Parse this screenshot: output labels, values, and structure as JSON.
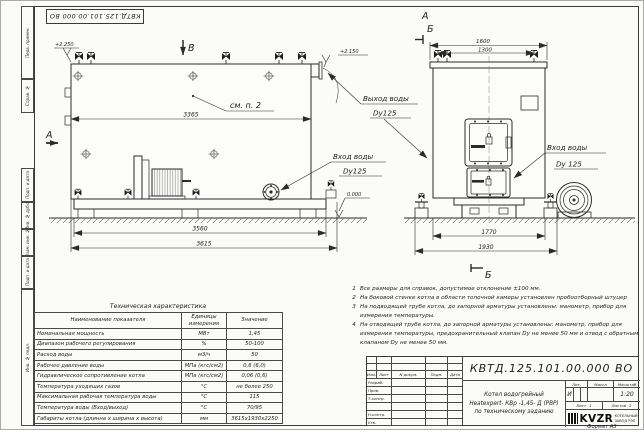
{
  "colors": {
    "line": "#2b2b2b",
    "paper": "#fbfbf8"
  },
  "sheet": {
    "stamp": "КВТД.125.101.00.000 ВО",
    "format": "Формат А3",
    "margin": [
      "Перв. примен.",
      "Справ. №",
      "Подп. и дата",
      "Инв. № дубл.",
      "Взам. инв. №",
      "Подп. и дата",
      "Инв. № подл."
    ]
  },
  "side": {
    "view_b": "В",
    "section_a": "А",
    "elev1": "+2.250",
    "elev2": "+2.150",
    "elev0": "0.000",
    "see_note": "см. п. 2",
    "dim_top": "3365",
    "dim_mid": "3560",
    "dim_out": "3615",
    "inlet1": "Вход воды",
    "inlet2": "Dy125",
    "outlet1": "Выход воды",
    "outlet2": "Dy125"
  },
  "front": {
    "label_a": "А",
    "label_b": "Б",
    "label_b2": "Б",
    "dim1": "1600",
    "dim2": "1300",
    "dim3": "1770",
    "dim4": "1930",
    "inlet1": "Вход воды",
    "inlet2": "Dy 125"
  },
  "notes": [
    {
      "n": "1",
      "t": "Все размеры для справок, допустимое отклонение ±100 мм."
    },
    {
      "n": "2",
      "t": "На боковой стенке котла в области топочной камеры установлен пробоотборный штуцер"
    },
    {
      "n": "3",
      "t": "На подводящей трубе котла, до запорной арматуры установлены: манометр, прибор для измерения температуры."
    },
    {
      "n": "4",
      "t": "На отводящей трубе котла, до запорной арматуры установлены: манометр, прибор для измерения температуры, предохранительный клапан Dу не менее 50 мм и отвод с обратным клапаном Dу не менее 50 мм."
    }
  ],
  "spec": {
    "title": "Техническая характеристика",
    "headers": [
      "Наименование показателя",
      "Единицы измерения",
      "Значение"
    ],
    "rows": [
      [
        "Номинальная мощность",
        "МВт",
        "1,45"
      ],
      [
        "Диапазон рабочего регулирования",
        "%",
        "50-100"
      ],
      [
        "Расход воды",
        "м3/ч",
        "50"
      ],
      [
        "Рабочее давление воды",
        "МПа (кгс/см2)",
        "0,6 (6,0)"
      ],
      [
        "Гидравлическое сопротивление котла",
        "МПа (кгс/см2)",
        "0,06 (0,6)"
      ],
      [
        "Температура уходящих газов",
        "°С",
        "не более 250"
      ],
      [
        "Максимальная рабочая температура воды",
        "°С",
        "115"
      ],
      [
        "Температура воды (Вход/выход)",
        "°С",
        "70/95"
      ],
      [
        "Габариты котла (длинна х ширина х высота)",
        "мм",
        "3615х1930х2250"
      ]
    ]
  },
  "tb": {
    "doc": "КВТД.125.101.00.000 ВО",
    "name1": "Котел водогрейный",
    "name2": "Heatexpert- КВр -1,45- Д (РВР)",
    "name3": "по техническому заданию",
    "cols": [
      "Изм.",
      "Лист",
      "N докум.",
      "Подп.",
      "Дата"
    ],
    "staff": [
      "Разраб.",
      "Пров.",
      "Т.контр.",
      "",
      "Н.контр.",
      "Утв."
    ],
    "lit_h": "Лит.",
    "mass_h": "Масса",
    "scale_h": "Масштаб",
    "lit": "И",
    "scale": "1:20",
    "sheet_label": "Лист",
    "sheet_value": "1",
    "sheets_label": "Листов",
    "sheets_value": "2",
    "logo": "KVZR",
    "org1": "КОТЕЛЬНЫЙ",
    "org2": "ЗАВОД РЭП"
  }
}
